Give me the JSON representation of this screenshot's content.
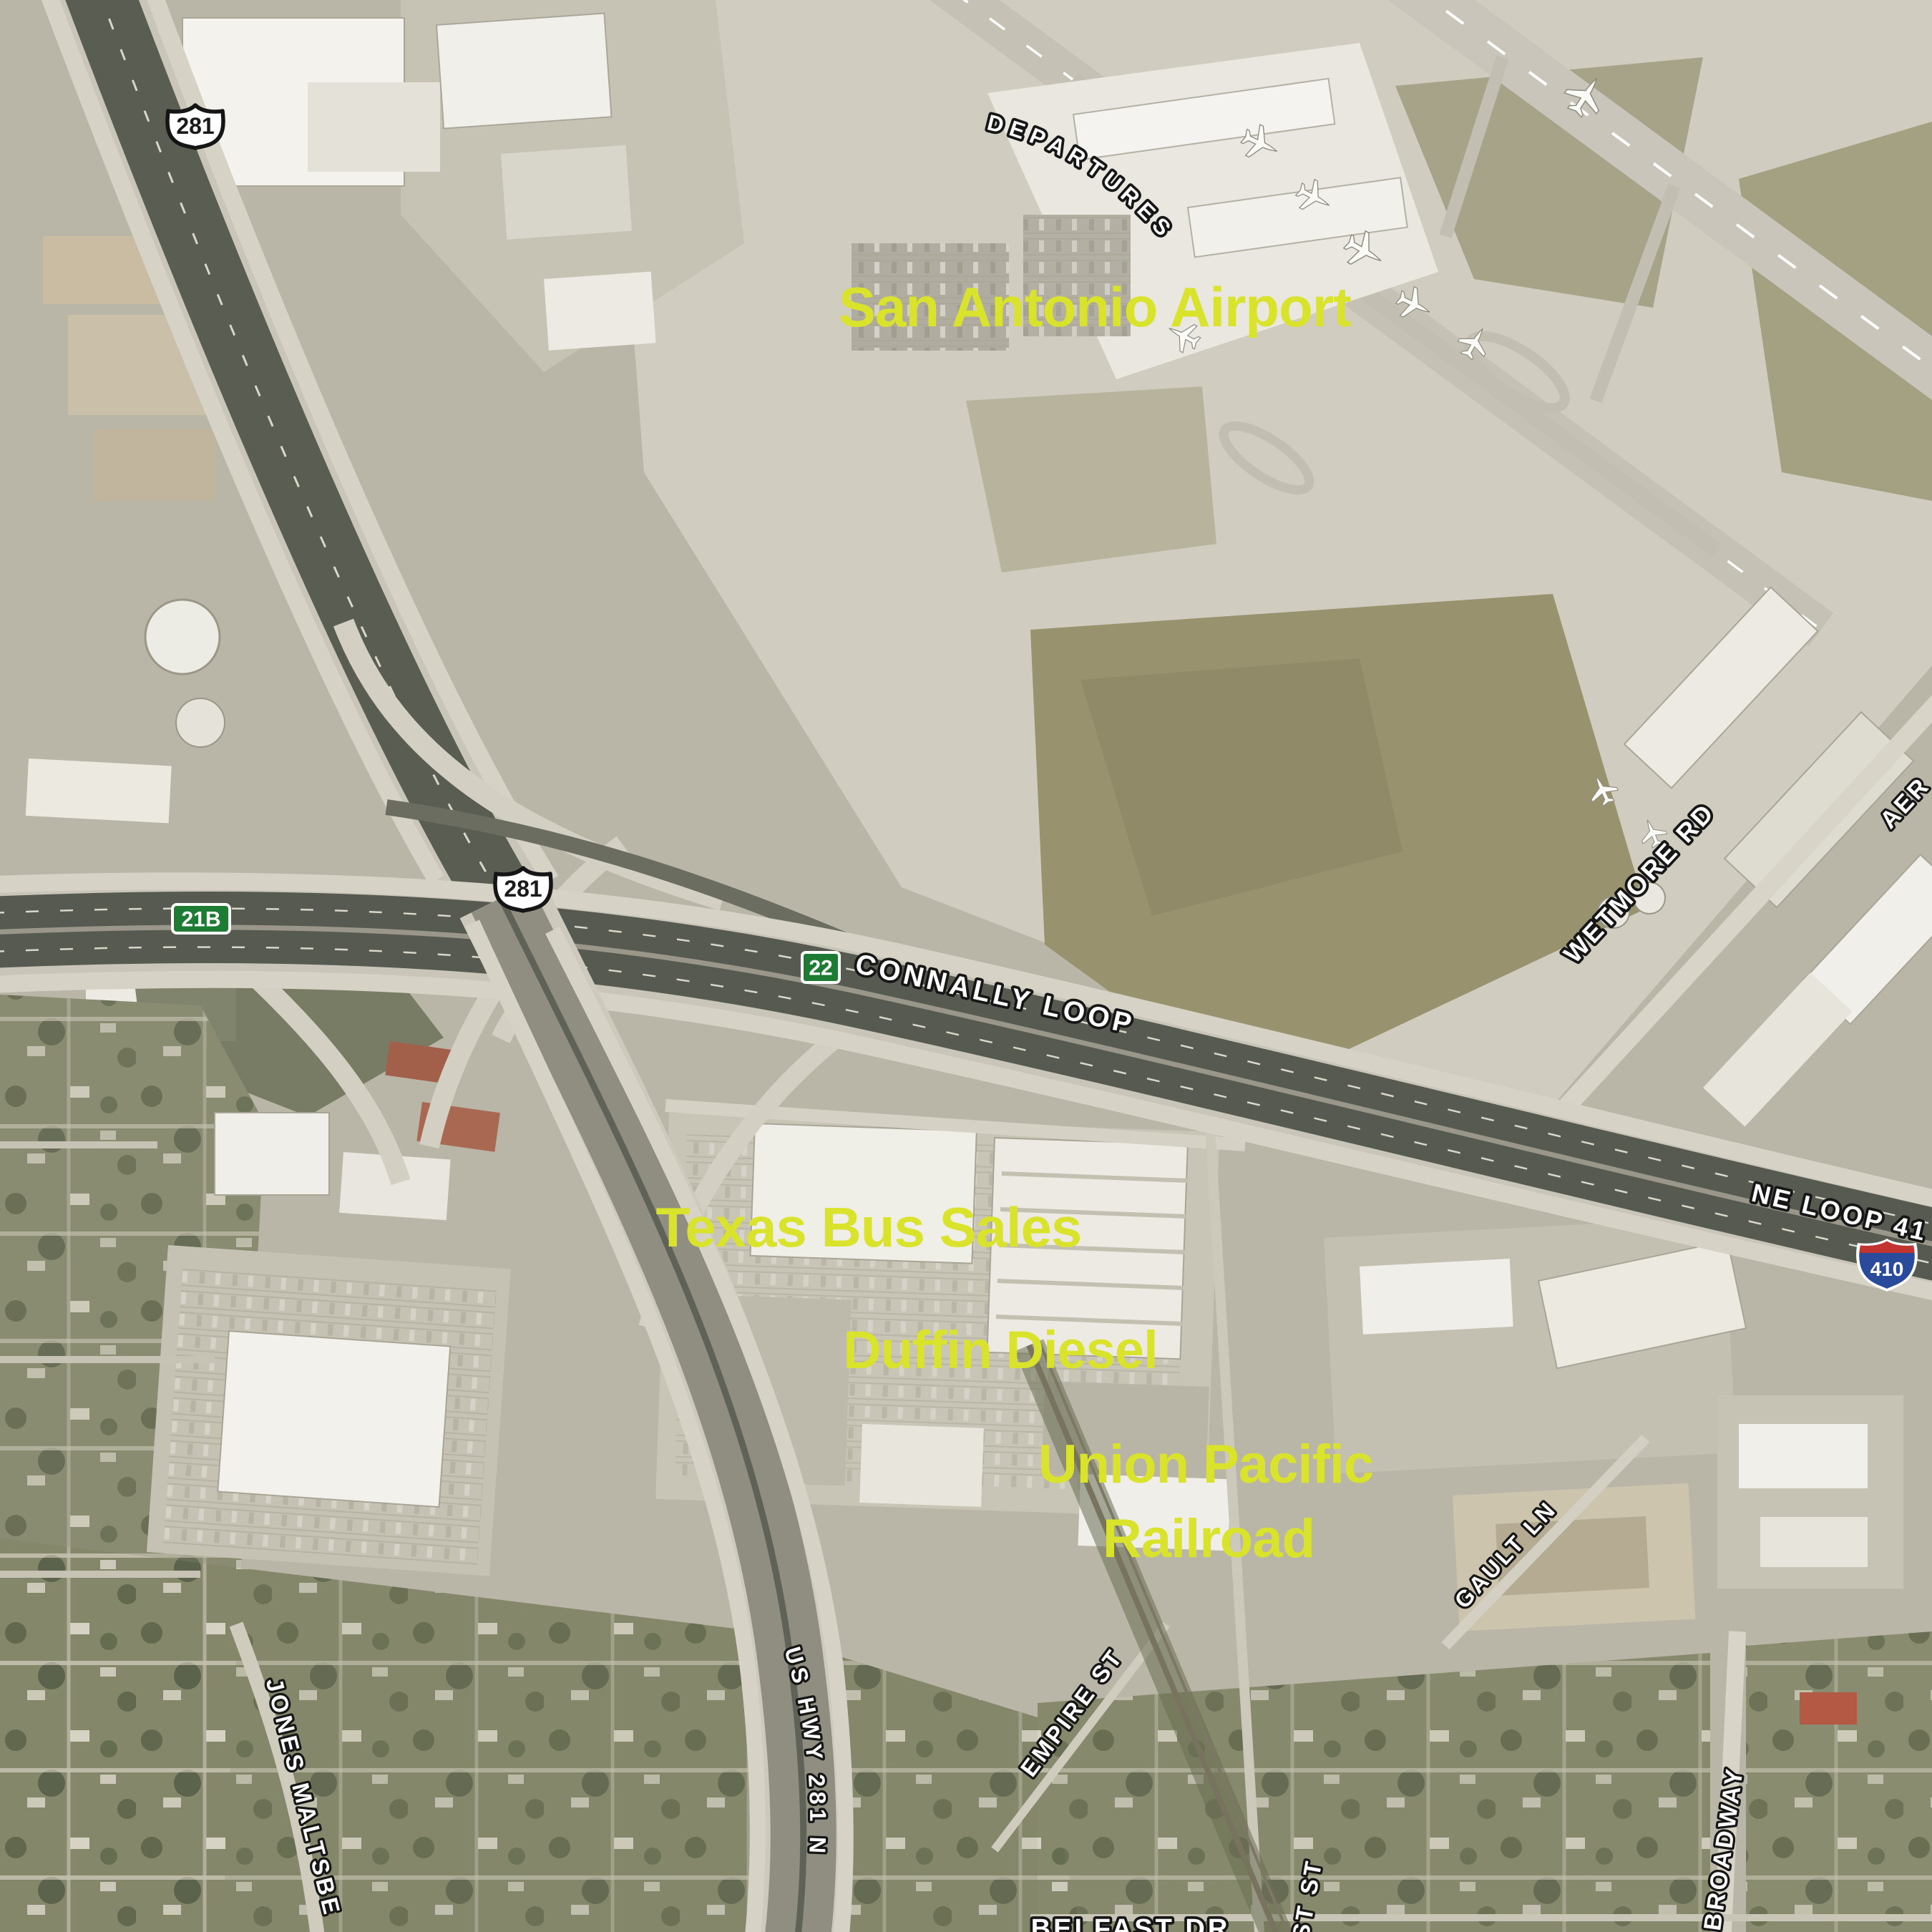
{
  "map": {
    "type": "satellite-aerial",
    "place_labels": {
      "airport": "San Antonio Airport",
      "texas_bus_sales": "Texas Bus Sales",
      "duffin_diesel": "Duffin Diesel",
      "union_pacific_line1": "Union Pacific",
      "union_pacific_line2": "Railroad"
    },
    "road_labels": {
      "departures": "DEPARTURES",
      "connally_loop": "CONNALLY LOOP",
      "wetmore_rd": "WETMORE RD",
      "ne_loop_410": "NE LOOP 41",
      "us_hwy_281_n": "US HWY 281 N",
      "jones_maltsberger": "JONES MALTSBE",
      "empire_st": "EMPIRE ST",
      "gault_ln": "GAULT LN",
      "broadway": "BROADWAY",
      "belfast_dr": "BELFAST DR",
      "st_st": "ST ST",
      "aer_partial": "AER"
    },
    "shields": {
      "us_281_north": "281",
      "us_281_interchange": "281",
      "exit_21b": "21B",
      "exit_22": "22",
      "interstate_410": "410"
    },
    "colors": {
      "place_label": "#d9e32b",
      "road_label_fill": "#ffffff",
      "road_label_outline": "#161616",
      "exit_sign_green": "#1e7b33",
      "interstate_blue": "#2a4a9b",
      "interstate_red": "#c23430",
      "us_shield_fill": "#ffffff"
    }
  }
}
